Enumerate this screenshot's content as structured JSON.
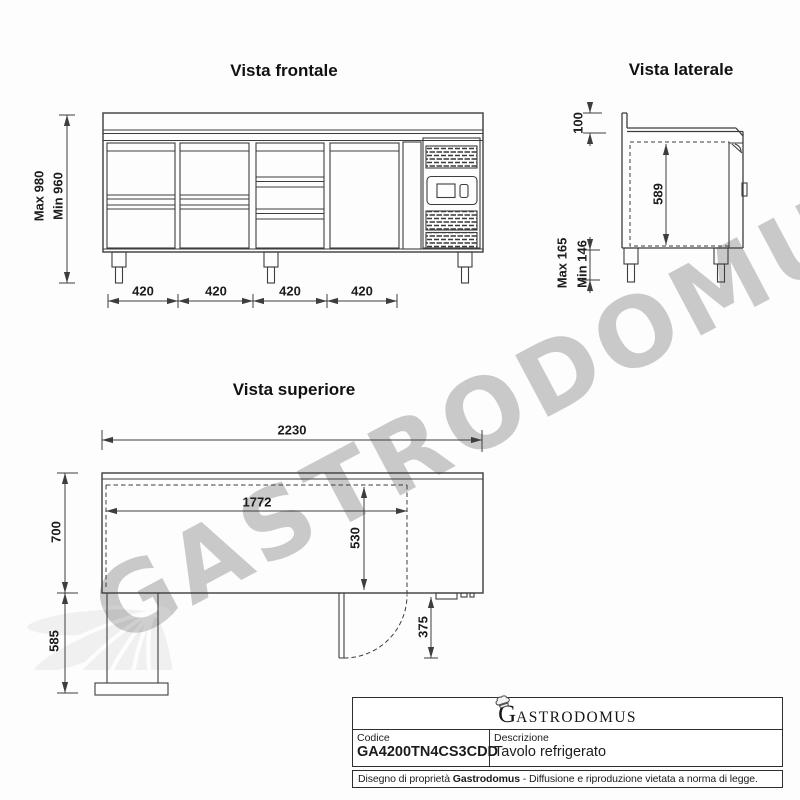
{
  "watermark": {
    "text": "GASTRODOMUS"
  },
  "views": {
    "front": {
      "title": "Vista frontale",
      "dim_height_max": "Max 980",
      "dim_height_min": "Min 960",
      "dim_sections": [
        "420",
        "420",
        "420",
        "420"
      ]
    },
    "side": {
      "title": "Vista laterale",
      "dim_backsplash": "100",
      "dim_interior_height": "589",
      "dim_leg_max": "Max 165",
      "dim_leg_min": "Min 146"
    },
    "top": {
      "title": "Vista superiore",
      "dim_total_width": "2230",
      "dim_inner_width": "1772",
      "dim_inner_depth": "530",
      "dim_depth": "700",
      "dim_drawer_extension": "585",
      "dim_door_swing": "375"
    }
  },
  "title_block": {
    "logo_initial": "G",
    "logo_rest": "ASTRODOMUS",
    "code_label": "Codice",
    "code_value": "GA4200TN4CS3CDD",
    "desc_label": "Descrizione",
    "desc_value": "Tavolo refrigerato",
    "footer_prefix": "Disegno di proprietà ",
    "footer_brand": "Gastrodomus",
    "footer_suffix": " - Diffusione e riproduzione vietata a norma di legge."
  }
}
